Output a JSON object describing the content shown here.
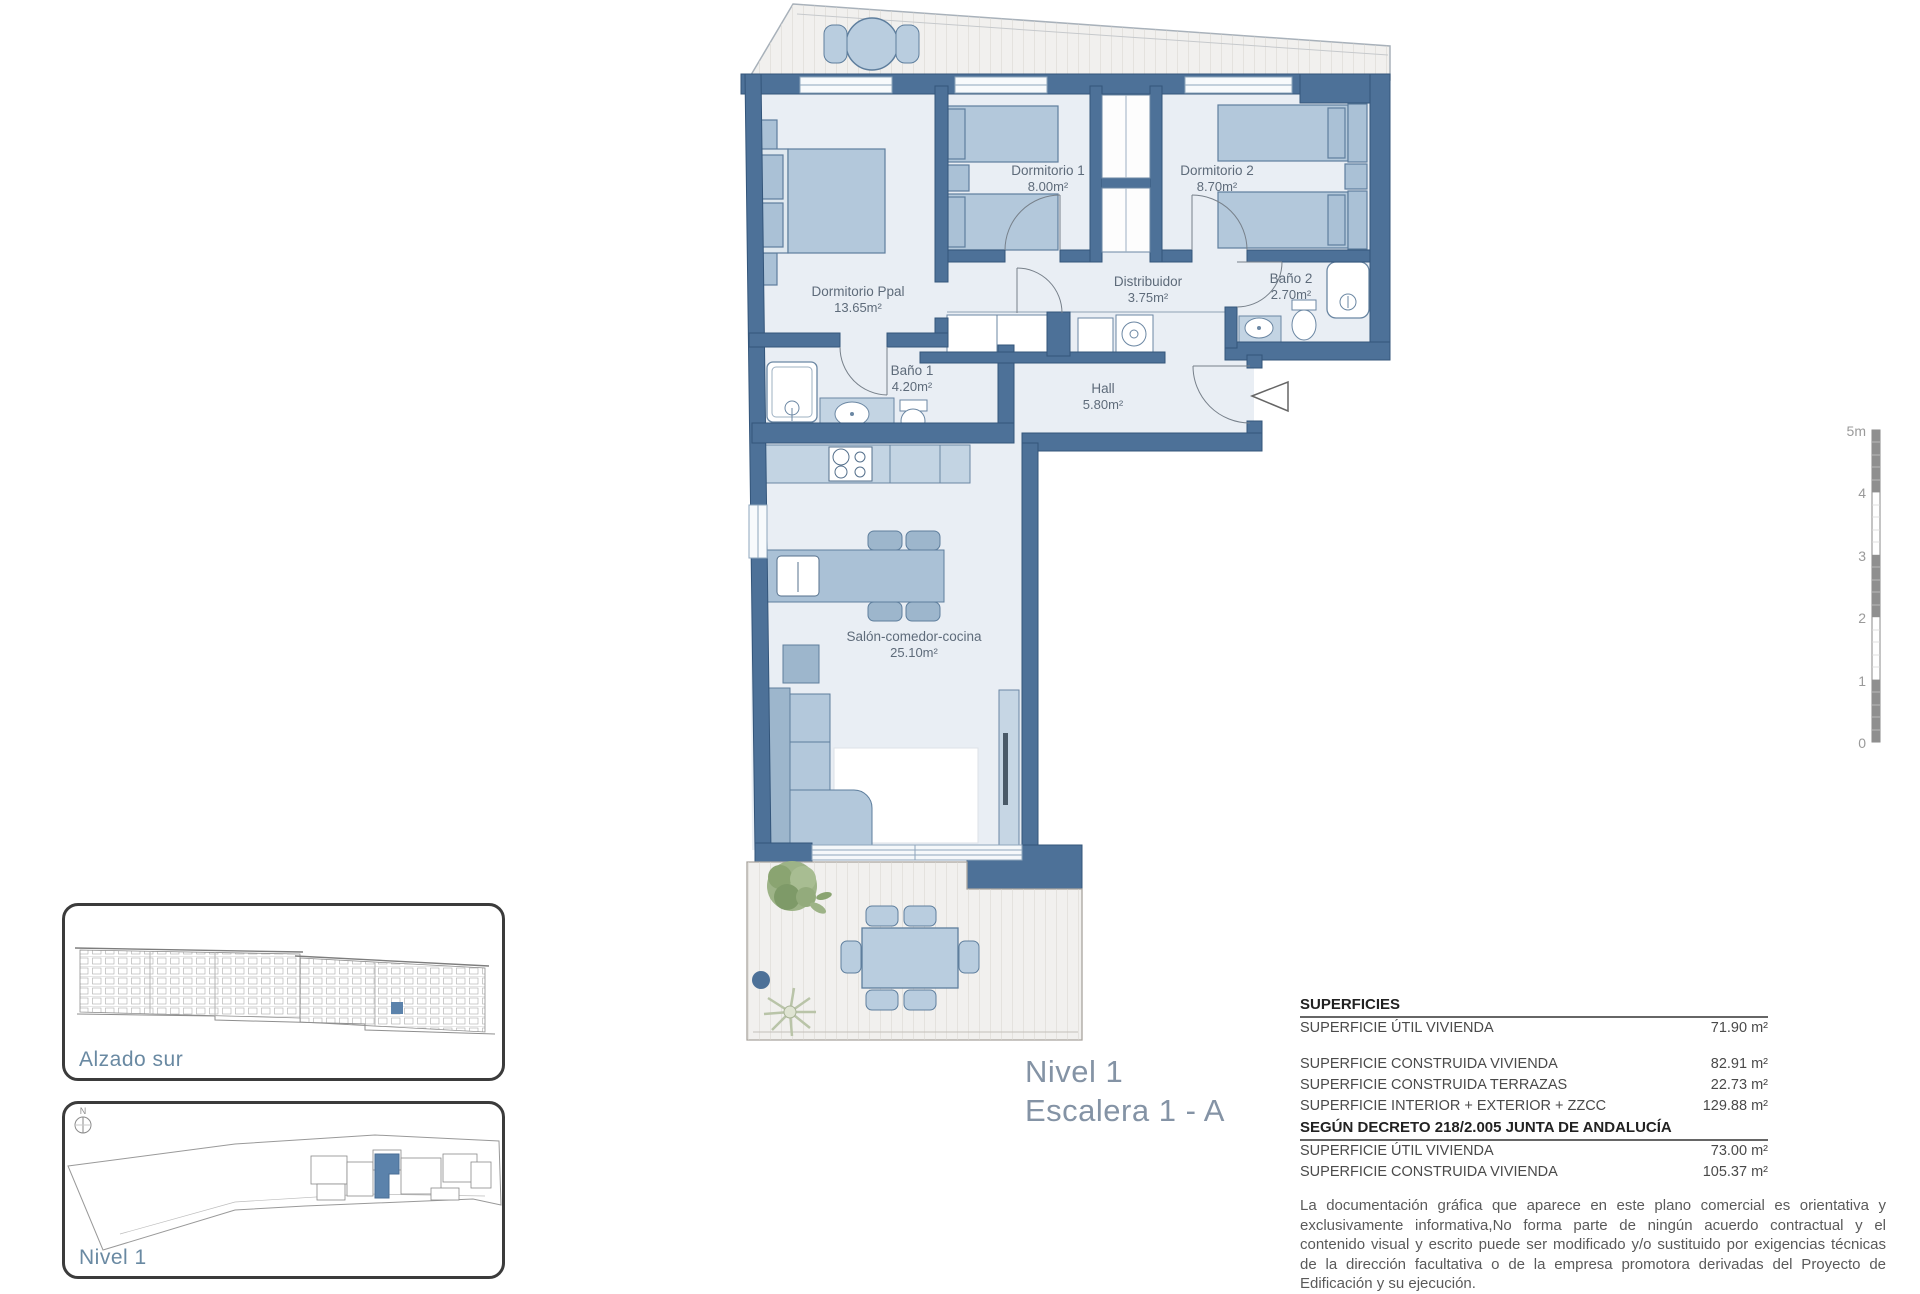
{
  "plan": {
    "title_line1": "Nivel 1",
    "title_line2": "Escalera 1 - A",
    "rooms": [
      {
        "name": "Dormitorio Ppal",
        "area": "13.65m²"
      },
      {
        "name": "Dormitorio 1",
        "area": "8.00m²"
      },
      {
        "name": "Dormitorio 2",
        "area": "8.70m²"
      },
      {
        "name": "Distribuidor",
        "area": "3.75m²"
      },
      {
        "name": "Baño 2",
        "area": "2.70m²"
      },
      {
        "name": "Baño 1",
        "area": "4.20m²"
      },
      {
        "name": "Hall",
        "area": "5.80m²"
      },
      {
        "name": "Salón-comedor-cocina",
        "area": "25.10m²"
      }
    ],
    "scale_ticks": [
      "5m",
      "4",
      "3",
      "2",
      "1",
      "0"
    ],
    "colors": {
      "wall": "#4d7198",
      "room_fill": "#e9eef4",
      "furniture": "#aac1d6",
      "highlight_unit": "#5b82ab"
    }
  },
  "insets": {
    "alzado": {
      "label": "Alzado sur"
    },
    "nivel": {
      "label": "Nivel 1",
      "north_label": "N"
    }
  },
  "surfaces": {
    "title": "SUPERFICIES",
    "rows": [
      {
        "label": "SUPERFICIE ÚTIL VIVIENDA",
        "value": "71.90 m²"
      },
      {
        "label": "SUPERFICIE CONSTRUIDA VIVIENDA",
        "value": "82.91 m²"
      },
      {
        "label": "SUPERFICIE CONSTRUIDA TERRAZAS",
        "value": "22.73 m²"
      },
      {
        "label": "SUPERFICIE INTERIOR + EXTERIOR + ZZCC",
        "value": "129.88 m²"
      }
    ],
    "decree_title": "SEGÚN DECRETO 218/2.005 JUNTA DE ANDALUCÍA",
    "decree_rows": [
      {
        "label": "SUPERFICIE ÚTIL VIVIENDA",
        "value": "73.00 m²"
      },
      {
        "label": "SUPERFICIE CONSTRUIDA VIVIENDA",
        "value": "105.37 m²"
      }
    ],
    "disclaimer": "La documentación gráfica que aparece en este plano comercial es orientativa y exclusivamente informativa,No forma parte de ningún acuerdo contractual y el contenido visual y escrito puede ser modificado y/o sustituido por exigencias técnicas de la dirección facultativa o de la empresa promotora derivadas del Proyecto de Edificación y su ejecución."
  }
}
